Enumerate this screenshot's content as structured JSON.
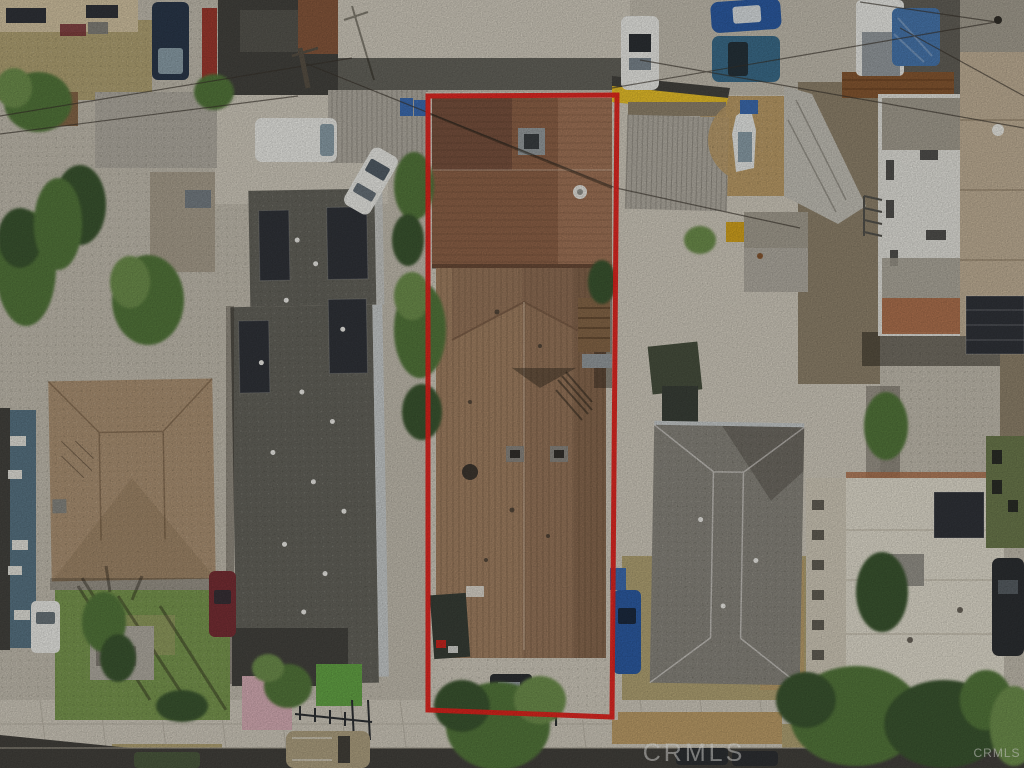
{
  "meta": {
    "image_type": "aerial-drone-photo",
    "subject": "residential lot outlined in red with two brown-roof houses, dense urban neighborhood, parked cars, street at bottom"
  },
  "watermarks": {
    "center": "CRMLS",
    "corner": "CRMLS"
  },
  "property_outline": {
    "meaning": "subject property boundary",
    "color_key": "red"
  },
  "scene": {
    "objects": [
      {
        "name": "subject-lot-outline",
        "color": "red"
      },
      {
        "name": "front-house-roof",
        "color": "roofFront"
      },
      {
        "name": "rear-house-roof",
        "color": "roofRear"
      },
      {
        "name": "gray-apartment-roof-with-solar-panels",
        "color": "grayRoof"
      },
      {
        "name": "tan-hip-roof-house",
        "color": "tanRoof"
      },
      {
        "name": "blue-house",
        "color": "blueHouse"
      },
      {
        "name": "corrugated-garage-roofs",
        "color": "garage"
      },
      {
        "name": "gray-hip-roof-house",
        "color": "grayRoofLight"
      },
      {
        "name": "cream-flat-roof-building",
        "color": "cream"
      },
      {
        "name": "white-apartment-building",
        "color": "whiteWall"
      },
      {
        "name": "yellow-awning",
        "color": "yellow"
      },
      {
        "name": "boat-on-dirt",
        "color": "boat"
      },
      {
        "name": "white-van",
        "color": "white"
      },
      {
        "name": "navy-van",
        "color": "navy"
      },
      {
        "name": "blue-car",
        "color": "blueCar"
      },
      {
        "name": "teal-sedan",
        "color": "tealCar"
      },
      {
        "name": "maroon-car",
        "color": "maroon"
      },
      {
        "name": "khaki-suv",
        "color": "khaki"
      },
      {
        "name": "street",
        "color": "asphalt"
      },
      {
        "name": "sidewalk",
        "color": "sidewalk"
      },
      {
        "name": "lawn",
        "color": "grass"
      },
      {
        "name": "trees",
        "color": "tree"
      }
    ]
  },
  "colors": {
    "concrete": "#c8c2b4",
    "concreteLight": "#d6d0c2",
    "concreteDark": "#a9a395",
    "sidewalk": "#d5cfc1",
    "asphalt": "#45433e",
    "dirt": "#c1a16b",
    "dryGrass": "#b6a777",
    "dirtShadow": "#93866f",
    "grass": "#7d9c52",
    "turf": "#67a948",
    "tree": "#567a3c",
    "treeDark": "#3c5830",
    "treeLight": "#719350",
    "roofFront": "#92654a",
    "roofFrontDark": "#7c5440",
    "roofFrontLight": "#a5775a",
    "roofRear": "#9c7a5e",
    "roofRearLight": "#b08e6e",
    "roofRearDark": "#7b5d46",
    "grayRoof": "#67665e",
    "grayRoofLight": "#8c8980",
    "litEdge": "#cdd1d1",
    "solar": "#32353b",
    "tanRoof": "#b19677",
    "tanRoofDark": "#967e5f",
    "tanLight": "#c6b59b",
    "blueHouse": "#5b7787",
    "garage": "#b6b1a6",
    "white": "#f1f1ec",
    "cream": "#e7e2d3",
    "creamShade": "#d6cfbe",
    "whiteWall": "#e9e8e1",
    "darkRoof": "#464540",
    "yellow": "#eec52c",
    "yellowDark": "#d9a820",
    "red": "#e8231d",
    "maroon": "#7b3036",
    "blueCar": "#2e5ea7",
    "tealCar": "#3d6f8e",
    "navy": "#2c3a4d",
    "khaki": "#b3a584",
    "greenCar": "#4e5c40",
    "darkCar": "#2e3134",
    "boat": "#eef0ed",
    "glass": "#8fa3ad",
    "wood": "#8a6a4a",
    "brownRoof": "#8a5a3e",
    "terracotta": "#b26f48",
    "pink": "#dcb2ba",
    "blueBin": "#3f6fb5",
    "shadow": "#241f17",
    "rust": "#8a5a33",
    "wire": "#3a342c",
    "banner": "#a23b30",
    "junkGreen": "#4a5240",
    "tarpGray": "#c9c6bc",
    "greenBldg": "#6f7d4f",
    "poleBrown": "#5b5347",
    "watermark": "#f7f6f2"
  }
}
